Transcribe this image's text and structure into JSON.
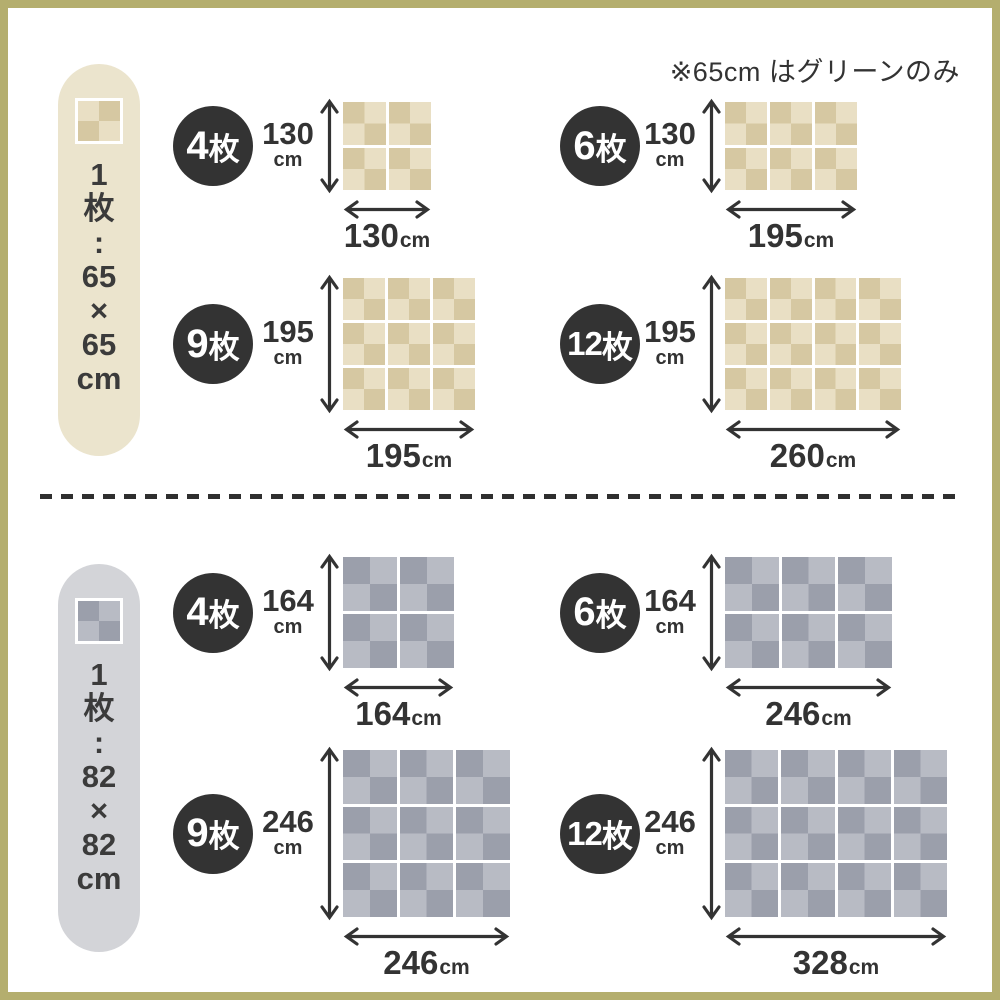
{
  "note": "※65cm はグリーンのみ",
  "colors": {
    "border": "#b4ae6e",
    "ink": "#333333",
    "badge": "#333333",
    "badge_text": "#ffffff",
    "divider": "#2f2f2f",
    "beige": {
      "pill": "#ebe4cd",
      "dark": "#d6c8a2",
      "light": "#e9dfc4"
    },
    "gray": {
      "pill": "#d3d4d8",
      "dark": "#9b9fab",
      "light": "#b8bbc4"
    }
  },
  "sections": [
    {
      "name": "65cm-mats",
      "theme": "beige",
      "pill": {
        "chars": [
          "1",
          "枚",
          ":",
          "65",
          "×",
          "65",
          "cm"
        ]
      },
      "groups": [
        {
          "count_num": "4",
          "count_suffix": "枚",
          "cols": 2,
          "rows": 2,
          "width_cm": 130,
          "height_cm": 130,
          "unit": "cm"
        },
        {
          "count_num": "6",
          "count_suffix": "枚",
          "cols": 3,
          "rows": 2,
          "width_cm": 195,
          "height_cm": 130,
          "unit": "cm"
        },
        {
          "count_num": "9",
          "count_suffix": "枚",
          "cols": 3,
          "rows": 3,
          "width_cm": 195,
          "height_cm": 195,
          "unit": "cm"
        },
        {
          "count_num": "12",
          "count_suffix": "枚",
          "cols": 4,
          "rows": 3,
          "width_cm": 260,
          "height_cm": 195,
          "unit": "cm"
        }
      ]
    },
    {
      "name": "82cm-mats",
      "theme": "gray",
      "pill": {
        "chars": [
          "1",
          "枚",
          ":",
          "82",
          "×",
          "82",
          "cm"
        ]
      },
      "groups": [
        {
          "count_num": "4",
          "count_suffix": "枚",
          "cols": 2,
          "rows": 2,
          "width_cm": 164,
          "height_cm": 164,
          "unit": "cm"
        },
        {
          "count_num": "6",
          "count_suffix": "枚",
          "cols": 3,
          "rows": 2,
          "width_cm": 246,
          "height_cm": 164,
          "unit": "cm"
        },
        {
          "count_num": "9",
          "count_suffix": "枚",
          "cols": 3,
          "rows": 3,
          "width_cm": 246,
          "height_cm": 246,
          "unit": "cm"
        },
        {
          "count_num": "12",
          "count_suffix": "枚",
          "cols": 4,
          "rows": 3,
          "width_cm": 328,
          "height_cm": 246,
          "unit": "cm"
        }
      ]
    }
  ]
}
